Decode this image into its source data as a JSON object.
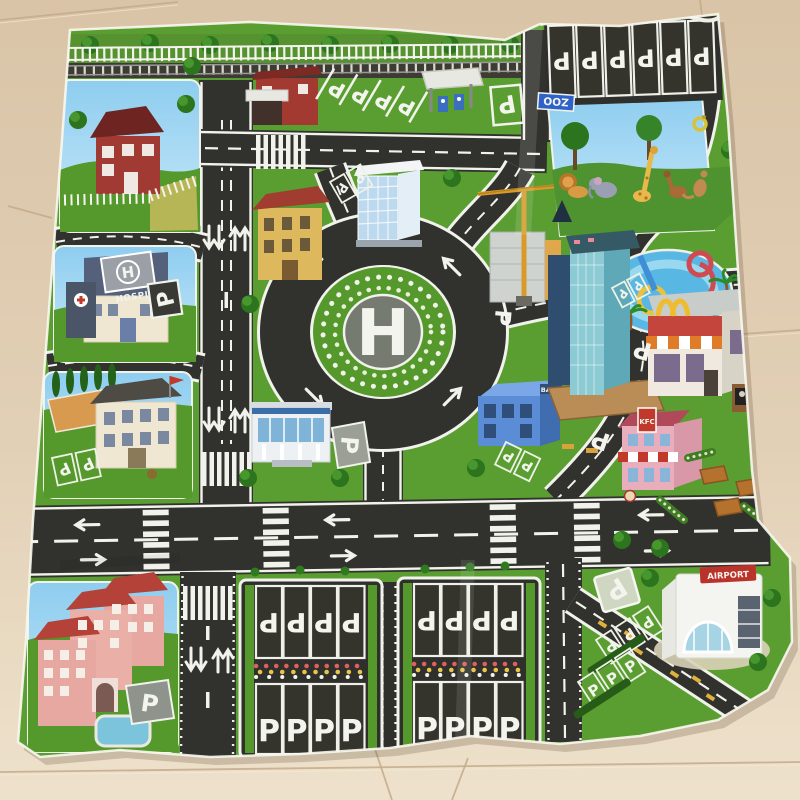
{
  "scene": {
    "type": "photograph",
    "subject": "children's city traffic play mat laid on a beige tile floor, edges curled"
  },
  "floor": {
    "tile_color": "#d9c4a7",
    "tile_light": "#eee1cb",
    "seam_color": "#c3aa8b"
  },
  "mat": {
    "grass_color": "#5a9e31",
    "road_color": "#31312d",
    "marking_color": "#f2f2ec",
    "panel_sky_color": "#8ecdef",
    "labels": {
      "parking": "P",
      "roundabout_helipad": "H",
      "hospital_roof": "H",
      "hospital_name": "HOSPITAL",
      "zoo_sign": "ZOO",
      "airport_sign": "AIRPORT",
      "bank_sign": "BANK",
      "kfc_sign": "KFC"
    },
    "landmarks": [
      "railway-with-fence",
      "farm-house",
      "fire-station",
      "fuel-station",
      "zoo",
      "water-park",
      "hospital-with-roof-helipad",
      "school",
      "apartment-complex-with-pool",
      "office-tower",
      "civic-building",
      "construction-crane-site",
      "police-station",
      "bank",
      "skyscraper",
      "fast-food-restaurant-golden-arches",
      "fried-chicken-restaurant",
      "picnic-area",
      "parking-lot-west",
      "parking-lot-east",
      "airport-terminal",
      "central-roundabout-helipad"
    ],
    "zoo_animals": [
      "lion",
      "elephant",
      "giraffe",
      "horse",
      "kangaroo",
      "snake"
    ],
    "parking_zones": [
      {
        "name": "zoo-top-band",
        "stalls": 6,
        "letters_rotated": true
      },
      {
        "name": "north-diagonal-bays",
        "stalls": 4
      },
      {
        "name": "zoo-entry-pad",
        "stalls": 1
      },
      {
        "name": "hospital-pad",
        "stalls": 1
      },
      {
        "name": "school-bays",
        "stalls": 2
      },
      {
        "name": "office-tower-bays",
        "stalls": 2
      },
      {
        "name": "police-pad",
        "stalls": 1
      },
      {
        "name": "bank-bays",
        "stalls": 2
      },
      {
        "name": "ring-east-road-mark",
        "stalls": 1
      },
      {
        "name": "restaurant-road-marks",
        "stalls": 2
      },
      {
        "name": "skyscraper-bays",
        "stalls": 2
      },
      {
        "name": "apartment-pad",
        "stalls": 1
      },
      {
        "name": "parking-lot-west",
        "rows": [
          [
            "P",
            "P",
            "P",
            "P"
          ],
          [
            "P",
            "P",
            "P",
            "P"
          ]
        ]
      },
      {
        "name": "parking-lot-east",
        "rows": [
          [
            "P",
            "P",
            "P",
            "P"
          ],
          [
            "P",
            "P",
            "P",
            "P"
          ]
        ]
      },
      {
        "name": "airport-pad",
        "stalls": 1
      },
      {
        "name": "airport-grass-bays",
        "stalls": 6
      }
    ]
  }
}
